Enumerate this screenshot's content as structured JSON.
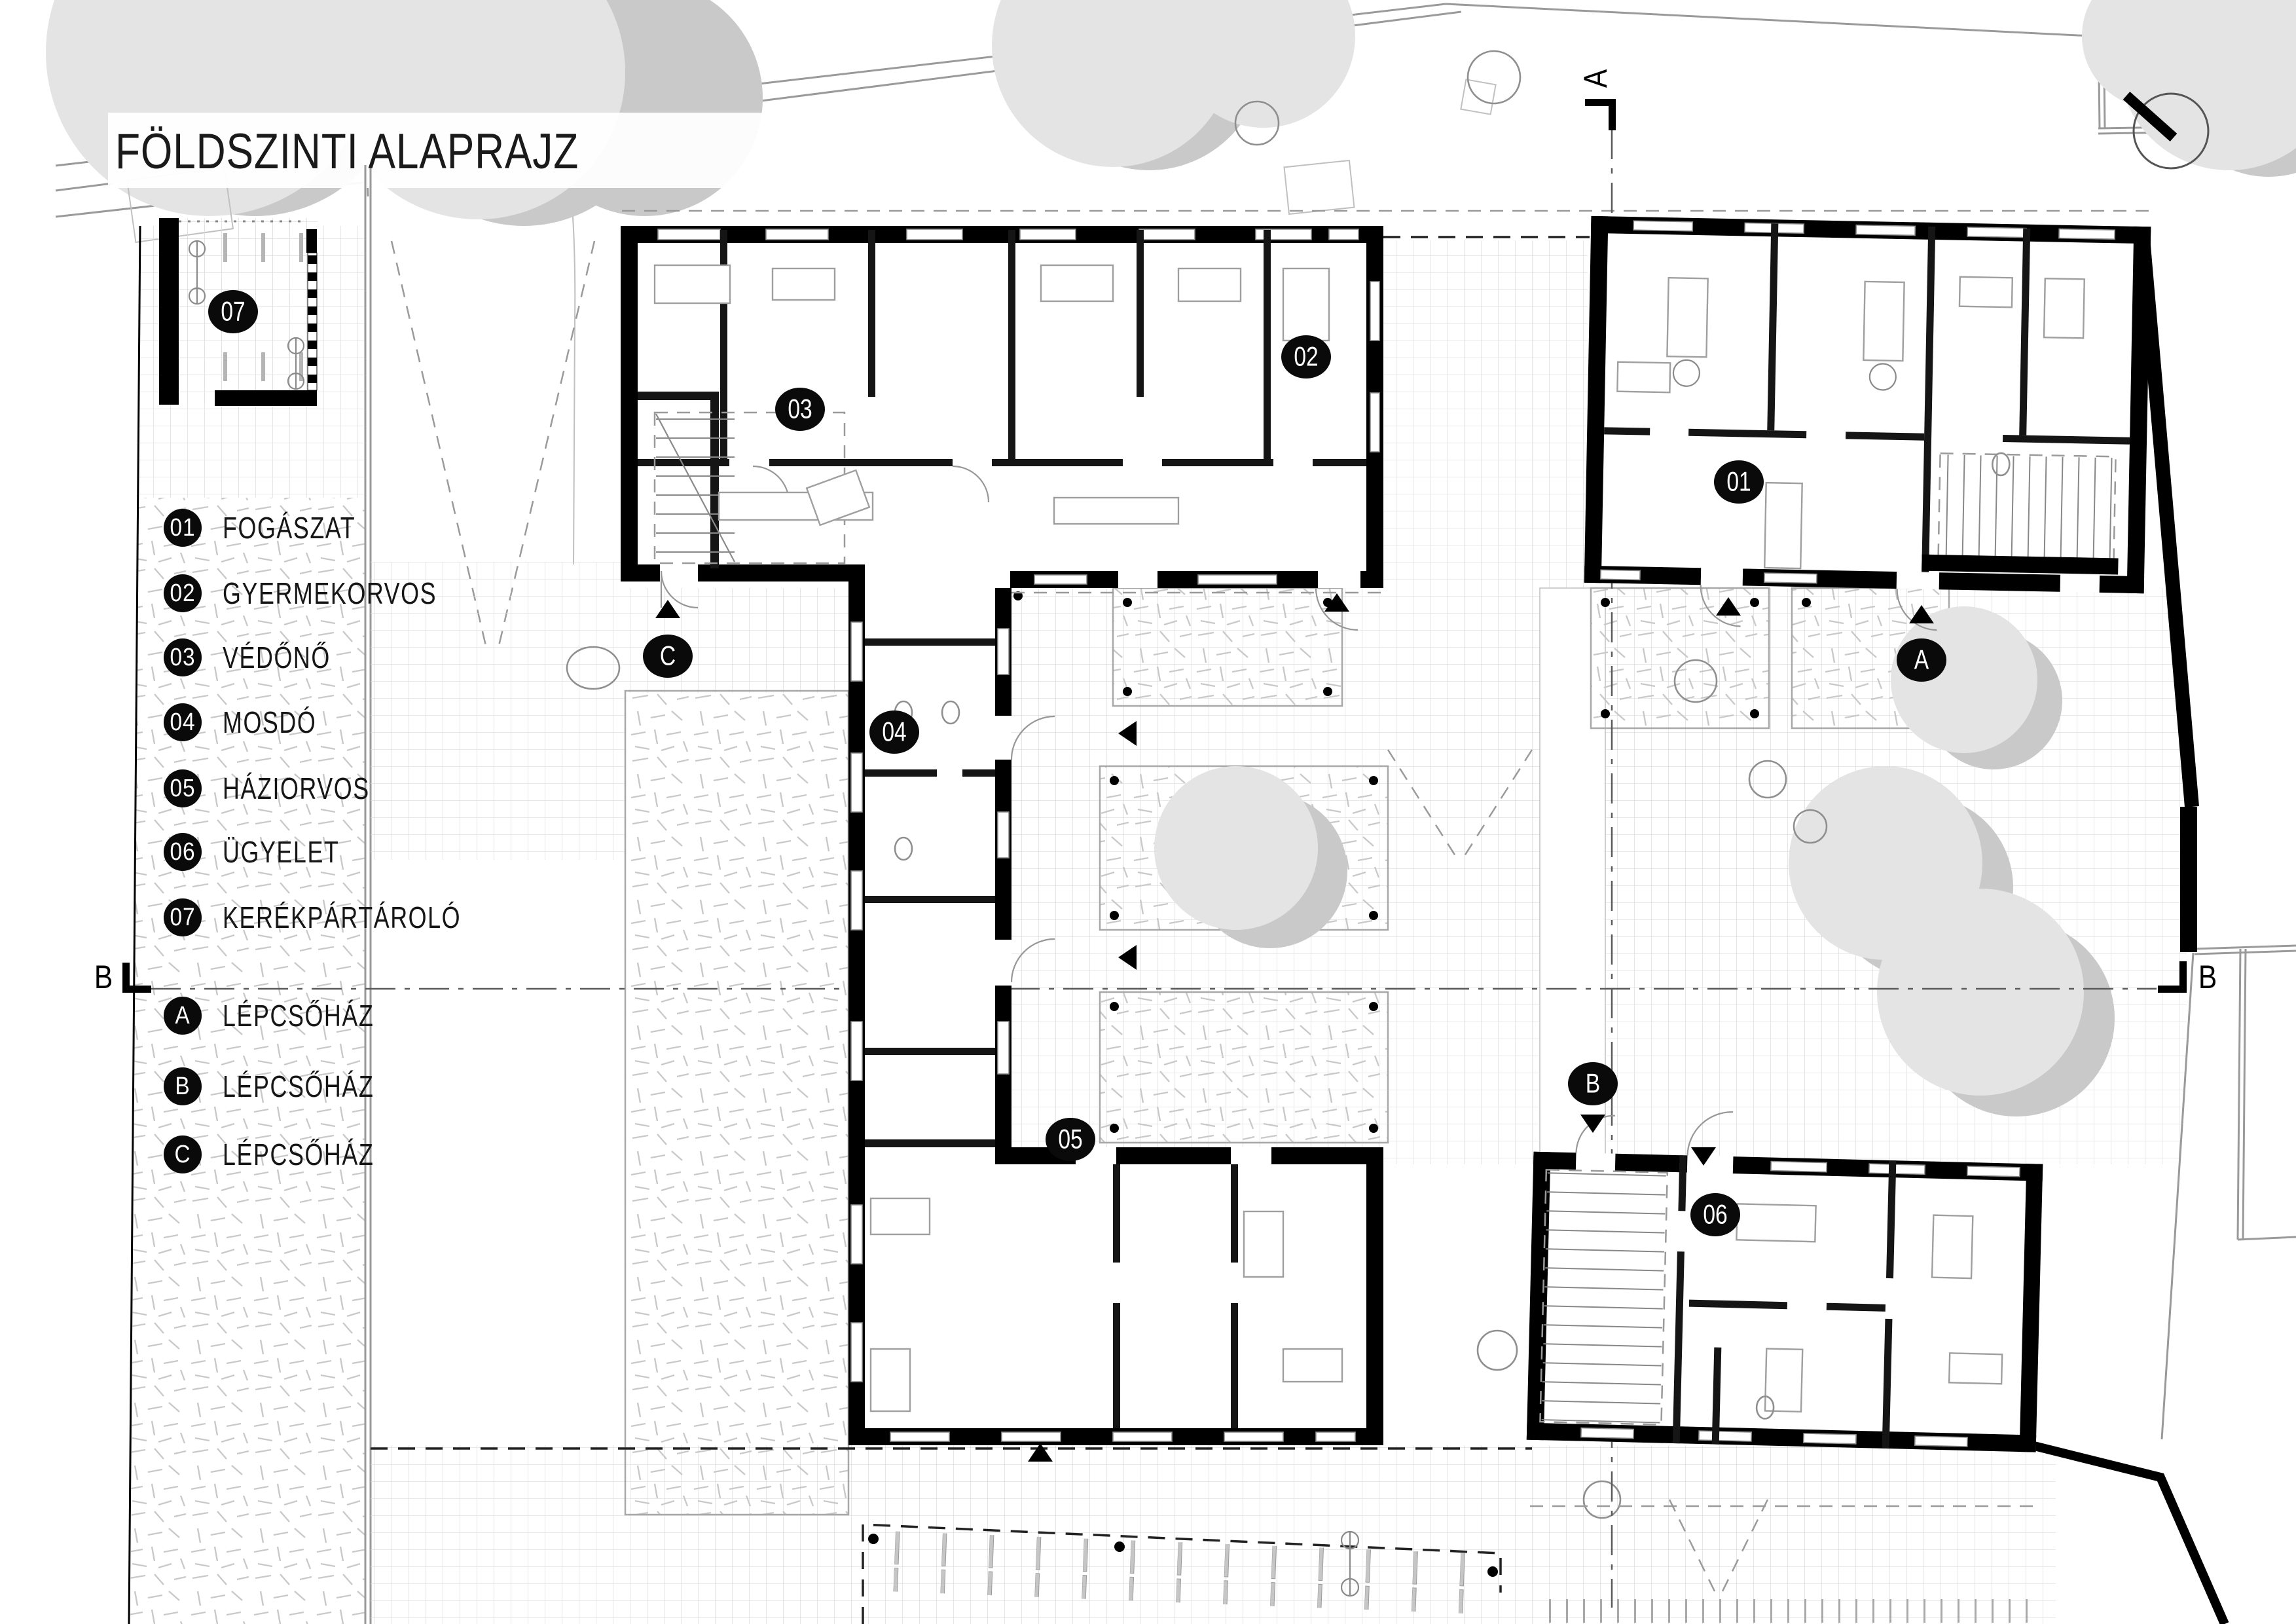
{
  "title": "FÖLDSZINTI ALAPRAJZ",
  "legend": {
    "items": [
      {
        "id": "01",
        "label": "FOGÁSZAT"
      },
      {
        "id": "02",
        "label": "GYERMEKORVOS"
      },
      {
        "id": "03",
        "label": "VÉDŐNŐ"
      },
      {
        "id": "04",
        "label": "MOSDÓ"
      },
      {
        "id": "05",
        "label": "HÁZIORVOS"
      },
      {
        "id": "06",
        "label": "ÜGYELET"
      },
      {
        "id": "07",
        "label": "KERÉKPÁRTÁROLÓ"
      },
      {
        "id": "A",
        "label": "LÉPCSŐHÁZ"
      },
      {
        "id": "B",
        "label": "LÉPCSŐHÁZ"
      },
      {
        "id": "C",
        "label": "LÉPCSŐHÁZ"
      }
    ]
  },
  "plan_badges": [
    {
      "label": "07"
    },
    {
      "label": "03"
    },
    {
      "label": "02"
    },
    {
      "label": "01"
    },
    {
      "label": "04"
    },
    {
      "label": "C"
    },
    {
      "label": "A"
    },
    {
      "label": "B"
    },
    {
      "label": "05"
    },
    {
      "label": "06"
    }
  ],
  "section_markers": [
    {
      "label": "A"
    },
    {
      "label": "B"
    },
    {
      "label": "B"
    }
  ],
  "colors": {
    "wall": "#000000",
    "context_line": "#9a9a9a",
    "speckle": "#c9c9c9",
    "paving_grid": "#d9d9d9",
    "tree_light": "#e4e4e4",
    "tree_dark": "#c9c9c9",
    "badge_bg": "#0a0a0a",
    "badge_text": "#ffffff"
  }
}
